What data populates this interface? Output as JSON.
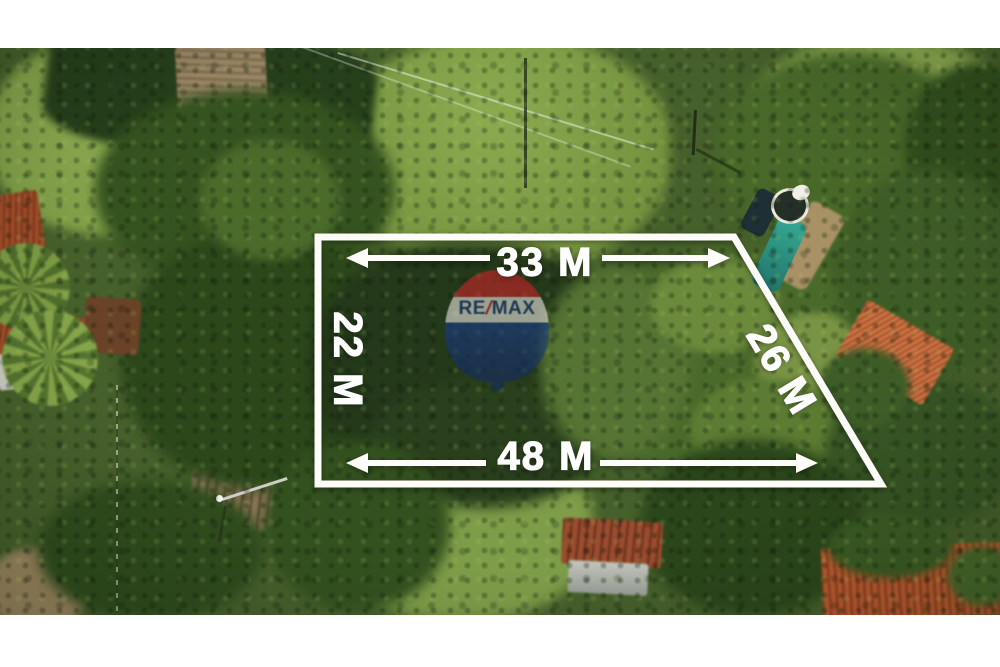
{
  "image": {
    "kind": "real-estate aerial drone photo with lot dimension overlay",
    "letterbox_color": "#ffffff"
  },
  "overlay": {
    "boundary_color": "#ffffff",
    "measurements": {
      "top": "33 M",
      "left": "22 M",
      "right": "26 M",
      "bottom": "48 M"
    }
  },
  "logo": {
    "brand": "RE/MAX",
    "part_re": "RE",
    "part_slash": "/",
    "part_max": "MAX",
    "balloon_red": "#d1242b",
    "balloon_white": "#f2efe8",
    "balloon_blue": "#1d3d8f"
  },
  "scene": {
    "elements": [
      "lawn",
      "dirt-road",
      "tree-canopy",
      "swimming-pool",
      "round-pool-tank",
      "red-tile-roofs",
      "rusty-shed-roof",
      "street-light",
      "power-lines",
      "palm-trees",
      "fence-line",
      "goal-post"
    ],
    "palette": {
      "grass_bright": "#86a44c",
      "grass_dark_field": "#263f1b",
      "canopy_dark": "#2c481b",
      "canopy_light": "#6c8a3c",
      "dirt": "#9b8866",
      "pool_teal": "#35a893",
      "roof_orange": "#bd5b2f",
      "shed_rust": "#9c4c2e"
    }
  }
}
